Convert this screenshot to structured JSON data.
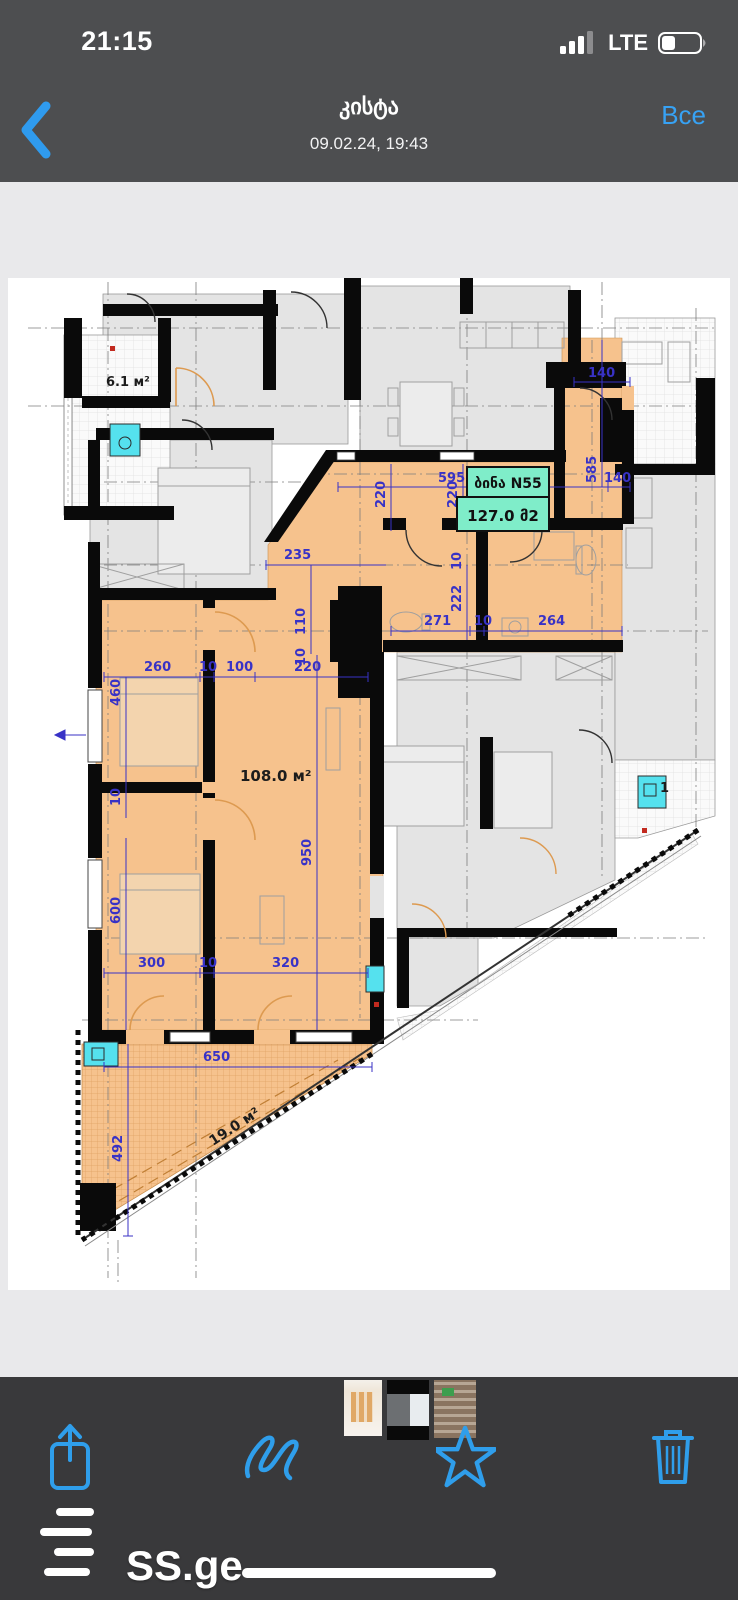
{
  "status_bar": {
    "time": "21:15",
    "network": "LTE",
    "icons": [
      "cellular-signal-icon",
      "battery-icon"
    ]
  },
  "nav": {
    "back_icon": "chevron-left-icon",
    "title": "კისტა",
    "subtitle": "09.02.24, 19:43",
    "all_label": "Все"
  },
  "floorplan": {
    "unit_label": "ბინა N55",
    "unit_area": "127.0 მ2",
    "room_areas": {
      "balcony": "6.1 м²",
      "main": "108.0 м²",
      "terrace": "19.0 м²"
    },
    "partial_label": "1",
    "dims": [
      "595",
      "220",
      "220",
      "585",
      "140",
      "140",
      "235",
      "110",
      "10",
      "260",
      "10",
      "100",
      "220",
      "460",
      "10",
      "271",
      "10",
      "264",
      "222",
      "10",
      "950",
      "600",
      "300",
      "10",
      "320",
      "650",
      "492"
    ],
    "colors": {
      "apartment_fill": "#F6C28D",
      "neighbor_fill": "#E4E4E4",
      "dimension_blue": "#3832C6",
      "label_teal": "#7FEDC9",
      "ac_cyan": "#55E1EE",
      "door_arc_orange": "#DD9A50",
      "wall_black": "#0A0A0A"
    }
  },
  "thumbnails": {
    "count": 3,
    "items": [
      {
        "name": "floorplan-thumbnail"
      },
      {
        "name": "building-photo-thumbnail"
      },
      {
        "name": "facade-thumbnail"
      }
    ]
  },
  "toolbar": {
    "watermark": "SS.ge",
    "icons": [
      "share-icon",
      "markup-icon",
      "star-icon",
      "trash-icon"
    ]
  }
}
